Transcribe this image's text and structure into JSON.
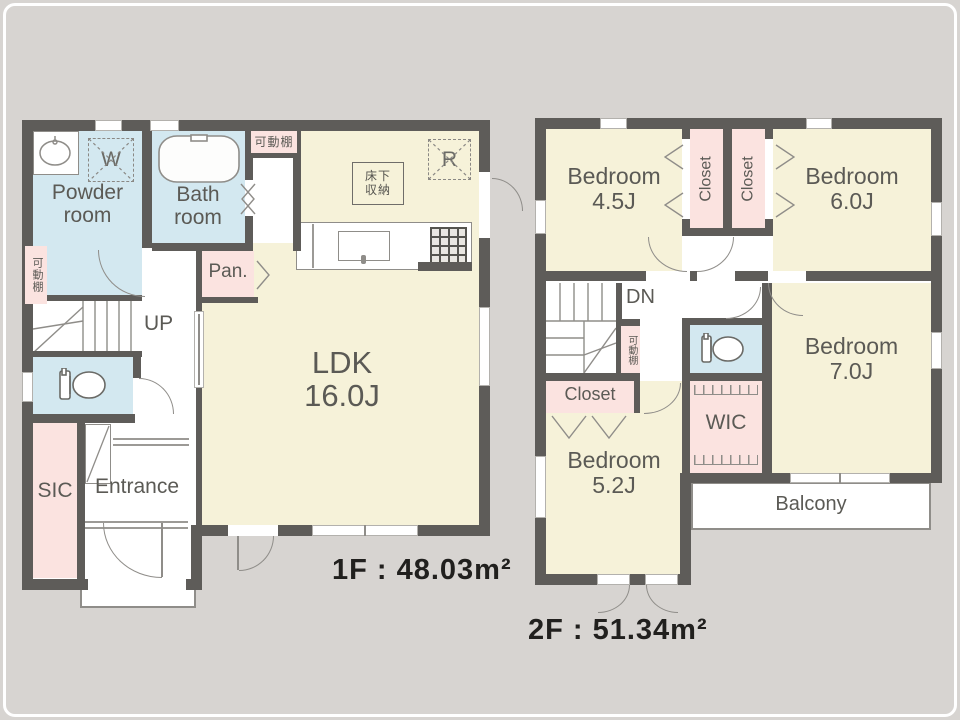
{
  "colors": {
    "wall": "#5e5c59",
    "yellow": "#f6f2d9",
    "blue": "#d3e8f0",
    "pink": "#fbe3e0",
    "bg": "#d7d4d1",
    "line": "#8f8d89",
    "text": "#5b5a55"
  },
  "floor1": {
    "area_text": "1F : 48.03m²",
    "labels": {
      "powder_1": "Powder",
      "powder_2": "room",
      "bath_1": "Bath",
      "bath_2": "room",
      "pan": "Pan.",
      "ldk_1": "LDK",
      "ldk_2": "16.0J",
      "up": "UP",
      "sic": "SIC",
      "entrance": "Entrance",
      "washer": "W",
      "fridge": "R",
      "shelf_top": "可動棚",
      "shelf_left": "可動棚",
      "underfloor_1": "床下",
      "underfloor_2": "収納"
    }
  },
  "floor2": {
    "area_text": "2F : 51.34m²",
    "labels": {
      "bedroom45_1": "Bedroom",
      "bedroom45_2": "4.5J",
      "bedroom60_1": "Bedroom",
      "bedroom60_2": "6.0J",
      "bedroom70_1": "Bedroom",
      "bedroom70_2": "7.0J",
      "bedroom52_1": "Bedroom",
      "bedroom52_2": "5.2J",
      "closet_a": "Closet",
      "closet_b": "Closet",
      "closet_c": "Closet",
      "wic": "WIC",
      "balcony": "Balcony",
      "dn": "DN",
      "shelf": "可動棚"
    }
  }
}
